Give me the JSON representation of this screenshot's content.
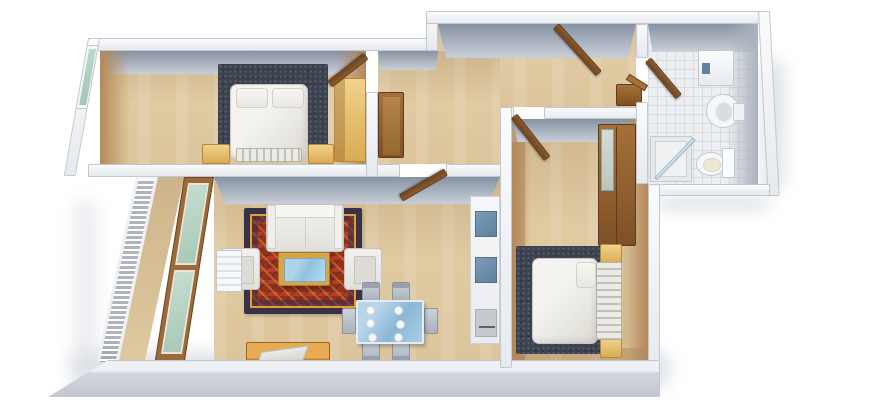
{
  "scene": {
    "type": "3d-floor-plan-render",
    "description": "Isometric 3D rendering of a two-bedroom apartment viewed from above, white walls, wood floors, furnished",
    "background": "#ffffff",
    "palette": {
      "wall": "#f0f1f4",
      "wall_edge": "#c6cbd3",
      "wall_inner_face": "#8793a3",
      "floor_wood": "#dcc59d",
      "floor_tile": "#edeef1",
      "side_wall_beige": "#b3885a",
      "wood_brown": "#9c6733",
      "wood_yellow": "#e8c36f",
      "wood_orange": "#d28a33",
      "glass_green": "#b7d4c5",
      "glass_blue": "#8fc2de",
      "rug_dark": "#3d434e",
      "rug_red": "#982f18",
      "fabric_white": "#ecebe7"
    }
  },
  "rooms": [
    {
      "id": "bedroom-1",
      "label": "Bedroom 1 (top left)",
      "furniture": [
        "double bed with white duvet",
        "dark area rug",
        "two yellow nightstands",
        "yellow wardrobe",
        "window",
        "open door"
      ]
    },
    {
      "id": "hallway",
      "label": "Hallway (top center)",
      "furniture": [
        "open entry door",
        "coat cabinet",
        "corner cabinet"
      ]
    },
    {
      "id": "bathroom",
      "label": "Bathroom (top right)",
      "furniture": [
        "washing machine",
        "pedestal sink",
        "toilet",
        "corner shower",
        "open door"
      ]
    },
    {
      "id": "living-room",
      "label": "Living room (bottom left)",
      "furniture": [
        "sofa",
        "two armchairs",
        "coffee table with blue glass",
        "red oriental rug",
        "TV stand",
        "glass dining table with plates",
        "four chairs",
        "shelving unit",
        "radiator",
        "window wall to balcony",
        "open door"
      ]
    },
    {
      "id": "bedroom-2",
      "label": "Bedroom 2 (bottom right)",
      "furniture": [
        "double bed with white duvet",
        "slatted headboard",
        "dark area rug",
        "two yellow nightstands",
        "brown wardrobe with mirror",
        "open door"
      ]
    },
    {
      "id": "balcony",
      "label": "Balcony (left)",
      "furniture": [
        "railing"
      ]
    }
  ]
}
